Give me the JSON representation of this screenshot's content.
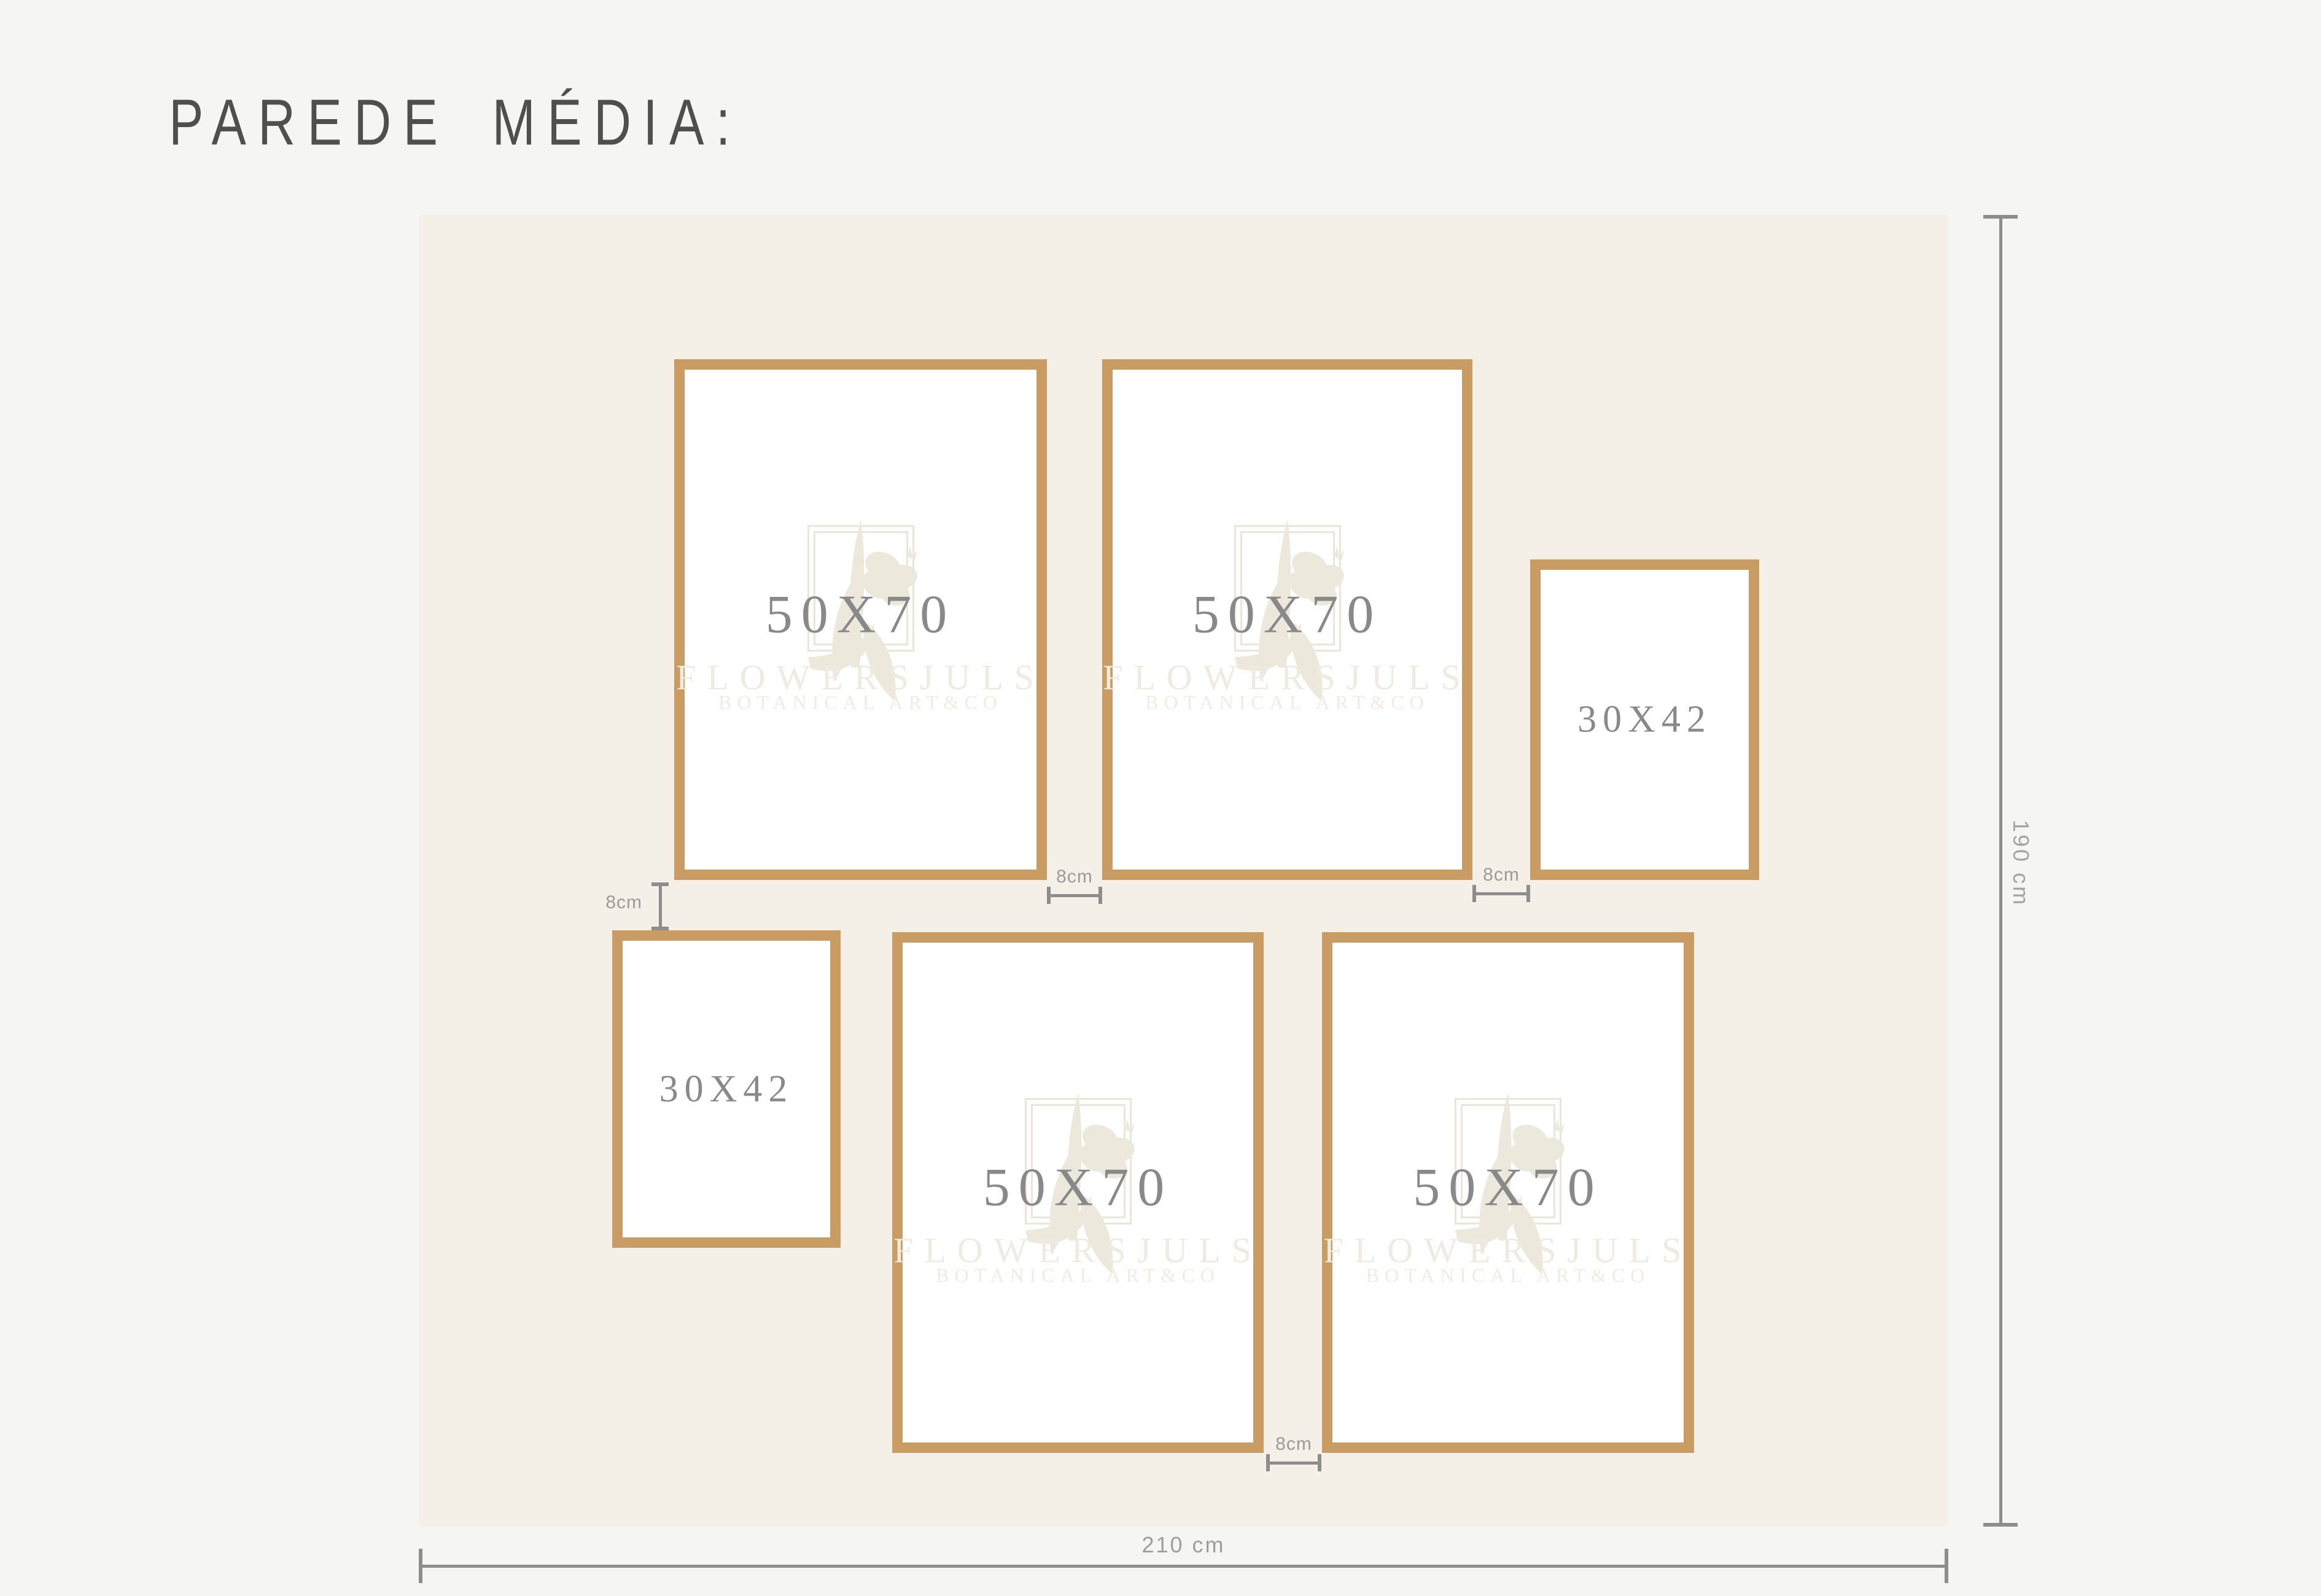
{
  "title": "PAREDE MÉDIA:",
  "wall": {
    "width_label": "210 cm",
    "height_label": "190 cm"
  },
  "gaps": {
    "ab": "8cm",
    "bc": "8cm",
    "ad": "8cm",
    "ef": "8cm"
  },
  "frames": [
    {
      "id": "top-left",
      "label": "50X70",
      "watermarked": true
    },
    {
      "id": "top-middle",
      "label": "50X70",
      "watermarked": true
    },
    {
      "id": "top-right",
      "label": "30X42",
      "watermarked": false
    },
    {
      "id": "bottom-left",
      "label": "30X42",
      "watermarked": false
    },
    {
      "id": "bottom-middle",
      "label": "50X70",
      "watermarked": true
    },
    {
      "id": "bottom-right",
      "label": "50X70",
      "watermarked": true
    }
  ],
  "watermark": {
    "brand": "FLOWERSJULS",
    "subtitle": "BOTANICAL ART&CO"
  },
  "colors": {
    "page_bg": "#f5f5f4",
    "wall_bg": "#f4efe7",
    "frame_border": "#c89c63",
    "frame_interior": "#ffffff",
    "title_text": "#4f4f4f",
    "size_label_text": "#898989",
    "dimension_text": "#9b9b9b",
    "dimension_line": "#8d8d8d",
    "watermark_tint": "#ece8dc"
  }
}
